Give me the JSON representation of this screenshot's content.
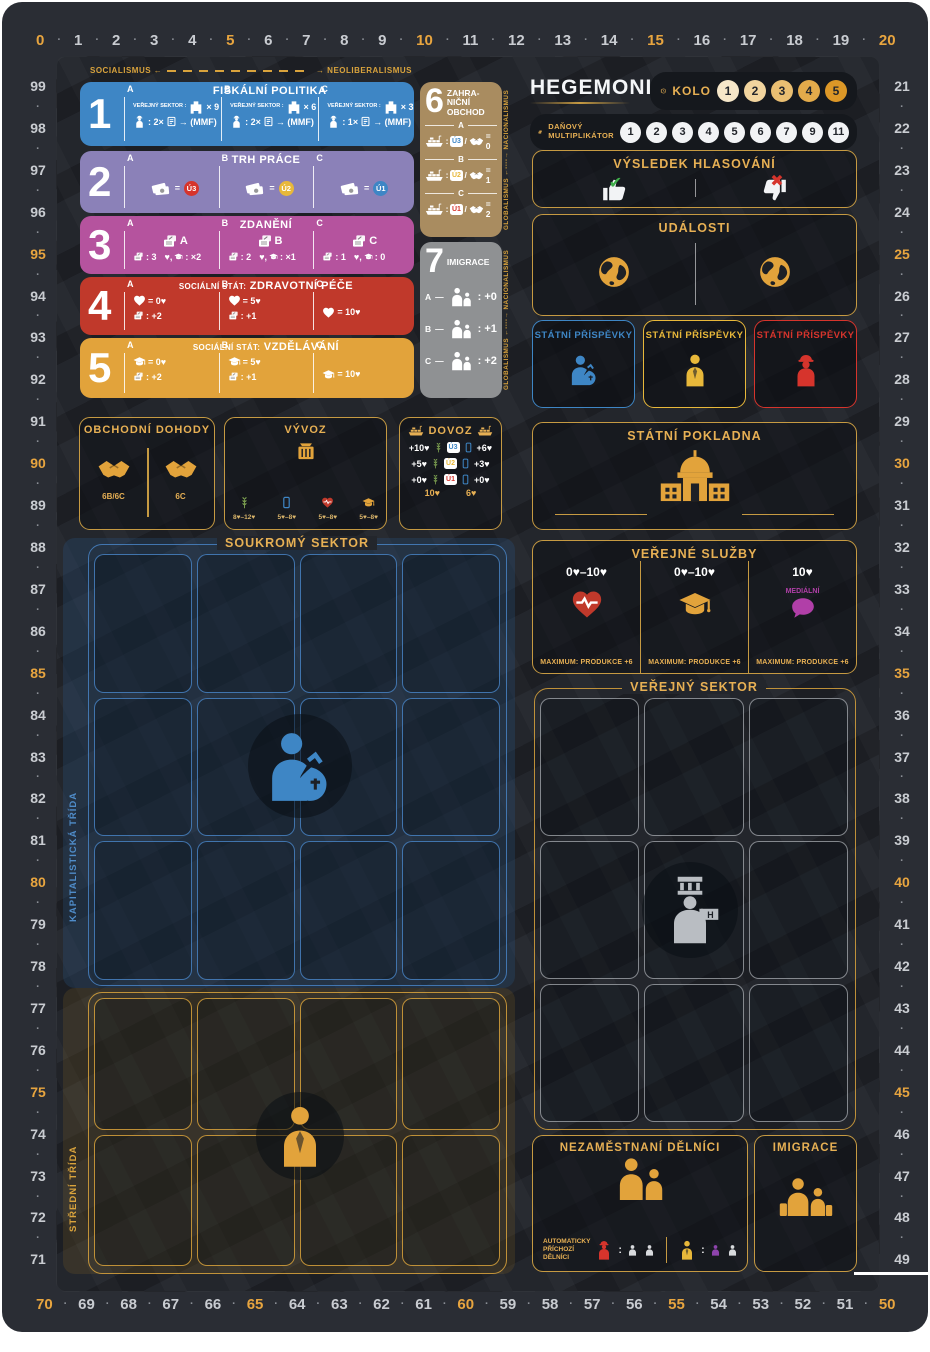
{
  "track": {
    "top": [
      "0",
      "1",
      "2",
      "3",
      "4",
      "5",
      "6",
      "7",
      "8",
      "9",
      "10",
      "11",
      "12",
      "13",
      "14",
      "15",
      "16",
      "17",
      "18",
      "19",
      "20"
    ],
    "right": [
      "21",
      "22",
      "23",
      "24",
      "25",
      "26",
      "27",
      "28",
      "29",
      "30",
      "31",
      "32",
      "33",
      "34",
      "35",
      "36",
      "37",
      "38",
      "39",
      "40",
      "41",
      "42",
      "43",
      "44",
      "45",
      "46",
      "47",
      "48",
      "49"
    ],
    "bottom": [
      "70",
      "69",
      "68",
      "67",
      "66",
      "65",
      "64",
      "63",
      "62",
      "61",
      "60",
      "59",
      "58",
      "57",
      "56",
      "55",
      "54",
      "53",
      "52",
      "51",
      "50"
    ],
    "left": [
      "99",
      "98",
      "97",
      "96",
      "95",
      "94",
      "93",
      "92",
      "91",
      "90",
      "89",
      "88",
      "87",
      "86",
      "85",
      "84",
      "83",
      "82",
      "81",
      "80",
      "79",
      "78",
      "77",
      "76",
      "75",
      "74",
      "73",
      "72",
      "71"
    ]
  },
  "axes": {
    "h_left": "SOCIALISMUS ←",
    "h_right": "→ NEOLIBERALISMUS",
    "v_text": "GLOBALISMUS ←----→ NACIONALISMUS"
  },
  "policies": {
    "r1": {
      "num": "1",
      "title": "FISKÁLNÍ POLITIKA",
      "sector_label": "VEŘEJNÝ SEKTOR :",
      "cols": [
        {
          "letter": "A",
          "mult": "× 9",
          "crew": ": 2×",
          "arrow": "→ (MMF)"
        },
        {
          "letter": "B",
          "mult": "× 6",
          "crew": ": 2×",
          "arrow": "→ (MMF)"
        },
        {
          "letter": "C",
          "mult": "× 3",
          "crew": ": 1×",
          "arrow": "→ (MMF)"
        }
      ]
    },
    "r2": {
      "num": "2",
      "title": "TRH PRÁCE",
      "cols": [
        {
          "letter": "A",
          "eq": "=",
          "badge": "Ú3",
          "color": "#d6342c"
        },
        {
          "letter": "B",
          "eq": "=",
          "badge": "Ú2",
          "color": "#e8b83a"
        },
        {
          "letter": "C",
          "eq": "=",
          "badge": "Ú1",
          "color": "#3e86c5"
        }
      ]
    },
    "r3": {
      "num": "3",
      "title": "ZDANĚNÍ",
      "cols": [
        {
          "letter": "A",
          "card": "A",
          "tax": ": 3",
          "svc": "♥,",
          "svc2": ": ×2"
        },
        {
          "letter": "B",
          "card": "B",
          "tax": ": 2",
          "svc": "♥,",
          "svc2": ": ×1"
        },
        {
          "letter": "C",
          "card": "C",
          "tax": ": 1",
          "svc": "♥,",
          "svc2": ": 0"
        }
      ]
    },
    "r4": {
      "num": "4",
      "title_small": "SOCIÁLNÍ STÁT:",
      "title": "ZDRAVOTNÍ PÉČE",
      "cols": [
        {
          "letter": "A",
          "val": "= 0♥",
          "doc": ": +2"
        },
        {
          "letter": "B",
          "val": "= 5♥",
          "doc": ": +1"
        },
        {
          "letter": "C",
          "val": "= 10♥",
          "doc": ""
        }
      ]
    },
    "r5": {
      "num": "5",
      "title_small": "SOCIÁLNÍ STÁT:",
      "title": "VZDĚLÁVÁNÍ",
      "cols": [
        {
          "letter": "A",
          "val": "= 0♥",
          "doc": ": +2"
        },
        {
          "letter": "B",
          "val": "= 5♥",
          "doc": ": +1"
        },
        {
          "letter": "C",
          "val": "= 10♥",
          "doc": ""
        }
      ]
    },
    "r6": {
      "num": "6",
      "t1": "ZAHRA-",
      "t2": "NIČNÍ",
      "t3": "OBCHOD",
      "rows": [
        {
          "letter": "A",
          "badge": "Ú3",
          "color": "#3e86c5",
          "eq": "= 0"
        },
        {
          "letter": "B",
          "badge": "Ú2",
          "color": "#e8b83a",
          "eq": "= 1"
        },
        {
          "letter": "C",
          "badge": "Ú1",
          "color": "#d6342c",
          "eq": "= 2"
        }
      ]
    },
    "r7": {
      "num": "7",
      "title": "IMIGRACE",
      "rows": [
        {
          "letter": "A",
          "val": ": +0"
        },
        {
          "letter": "B",
          "val": ": +1"
        },
        {
          "letter": "C",
          "val": ": +2"
        }
      ]
    }
  },
  "header": {
    "logo": "HEGEMONIE",
    "round_label": "KOLO",
    "rounds": [
      "1",
      "2",
      "3",
      "4",
      "5"
    ],
    "round_colors": [
      "#f6e7c9",
      "#f1d49e",
      "#eabf72",
      "#e3ab4b",
      "#dc9727"
    ],
    "tax_label_1": "DAŇOVÝ",
    "tax_label_2": "MULTIPLIKÁTOR",
    "tax_values": [
      "1",
      "2",
      "3",
      "4",
      "5",
      "6",
      "7",
      "9",
      "11"
    ]
  },
  "voting": {
    "title": "VÝSLEDEK HLASOVÁNÍ",
    "yes": "✔",
    "no": "✖"
  },
  "events": {
    "title": "UDÁLOSTI"
  },
  "contrib": {
    "title": "STÁTNÍ PŘÍSPĚVKY",
    "colors": [
      "#3e86c5",
      "#e8b83a",
      "#d6342c"
    ]
  },
  "treasury": {
    "title": "STÁTNÍ POKLADNA"
  },
  "services": {
    "title": "VEŘEJNÉ SLUŽBY",
    "cols": [
      {
        "range": "0♥–10♥",
        "max": "MAXIMUM: PRODUKCE +6"
      },
      {
        "range": "0♥–10♥",
        "max": "MAXIMUM: PRODUKCE +6"
      },
      {
        "range": "10♥",
        "tag": "MEDIÁLNÍ",
        "max": "MAXIMUM: PRODUKCE +6"
      }
    ]
  },
  "trade": {
    "title": "OBCHODNÍ DOHODY",
    "left": "6B/6C",
    "right": "6C"
  },
  "exports": {
    "title": "VÝVOZ",
    "items": [
      {
        "range": "8♥–12♥"
      },
      {
        "range": "5♥–8♥"
      },
      {
        "range": "5♥–8♥"
      },
      {
        "range": "5♥–8♥"
      }
    ]
  },
  "imports": {
    "title": "DOVOZ",
    "rows": [
      {
        "l": "+10♥",
        "badge": "Ú3",
        "color": "#3e86c5",
        "r": "+6♥"
      },
      {
        "l": "+5♥",
        "badge": "Ú2",
        "color": "#e8b83a",
        "r": "+3♥"
      },
      {
        "l": "+0♥",
        "badge": "Ú1",
        "color": "#d6342c",
        "r": "+0♥"
      }
    ],
    "wheat_total": "10♥",
    "phone_total": "6♥"
  },
  "sectors": {
    "private": "SOUKROMÝ SEKTOR",
    "public": "VEŘEJNÝ SEKTOR",
    "cap_class": "KAPITALISTICKÁ TŘÍDA",
    "mid_class": "STŘEDNÍ TŘÍDA"
  },
  "unemployed": {
    "title": "NEZAMĚSTNANÍ DĚLNÍCI",
    "auto_1": "AUTOMATICKY",
    "auto_2": "PŘÍCHOZÍ",
    "auto_3": "DĚLNÍCI"
  },
  "immigration": {
    "title": "IMIGRACE"
  }
}
